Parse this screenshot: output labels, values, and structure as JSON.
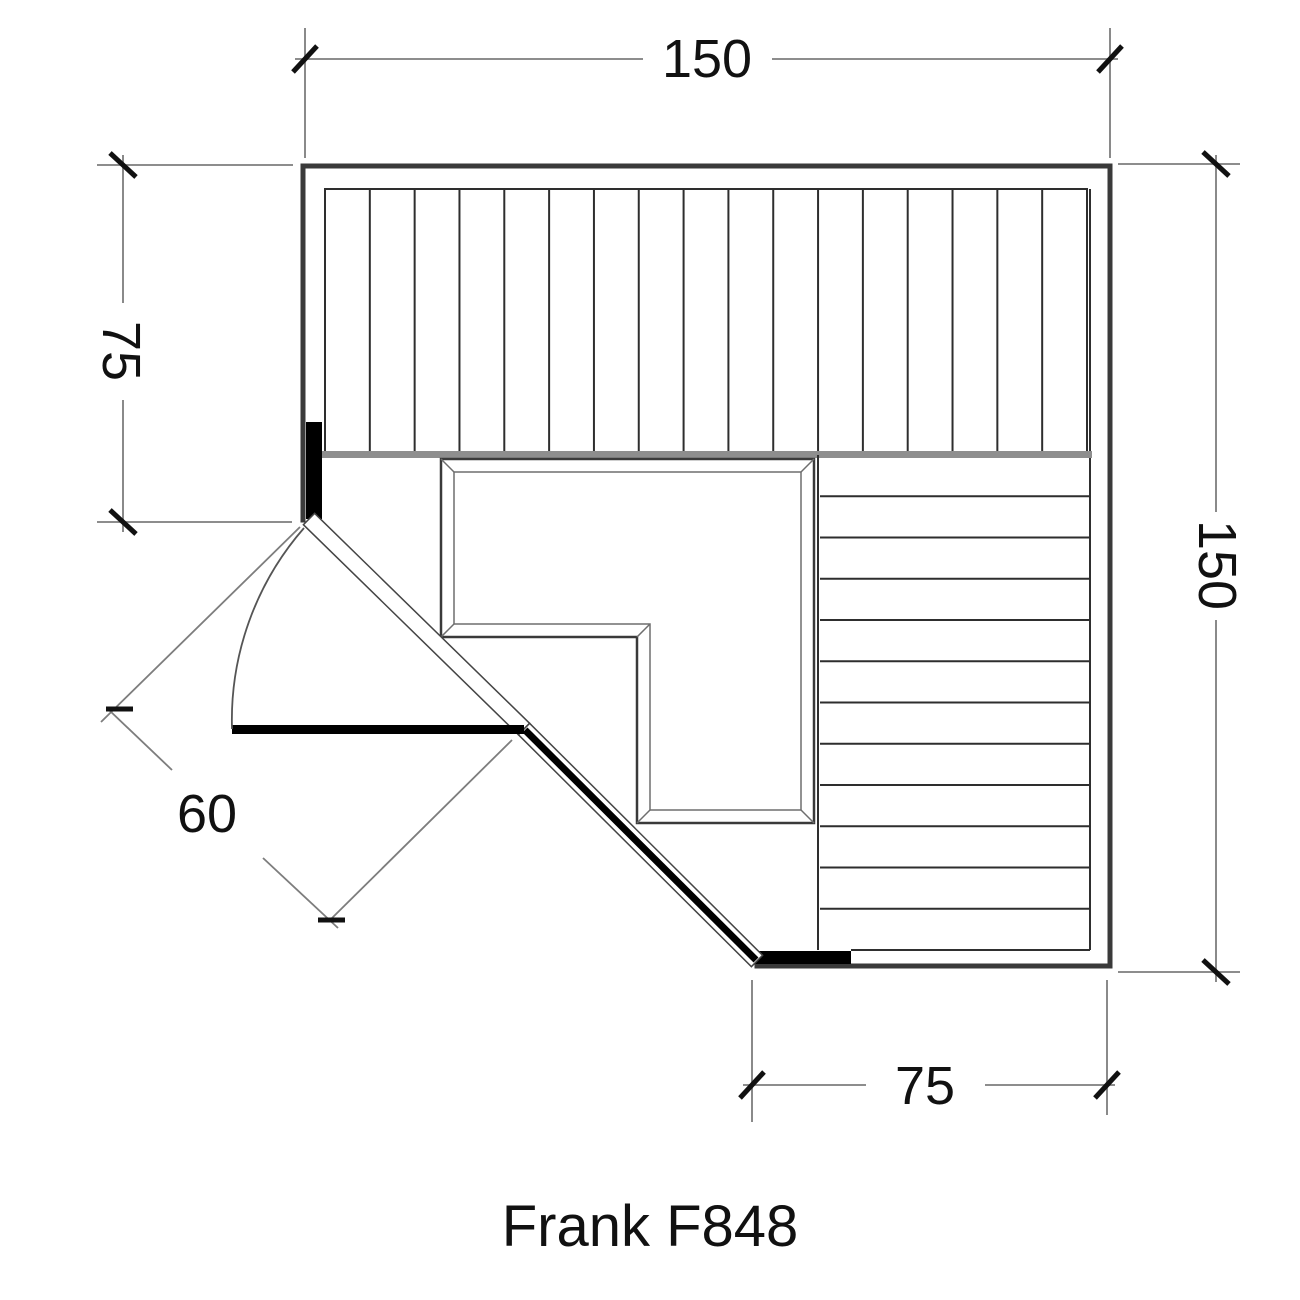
{
  "drawing": {
    "title": "Frank F848",
    "dimensions": {
      "width_top": "150",
      "height_left": "75",
      "height_right": "150",
      "width_bottom": "75",
      "door_width": "60"
    },
    "benches": {
      "top_slat_count": 17,
      "right_slat_count": 12
    },
    "colors": {
      "background": "#ffffff",
      "wall_dark": "#3a3a3a",
      "dimension_gray": "#7d7d7d",
      "bench_front_gray": "#8e8e8e",
      "door_black": "#000000",
      "text_black": "#111111"
    }
  }
}
